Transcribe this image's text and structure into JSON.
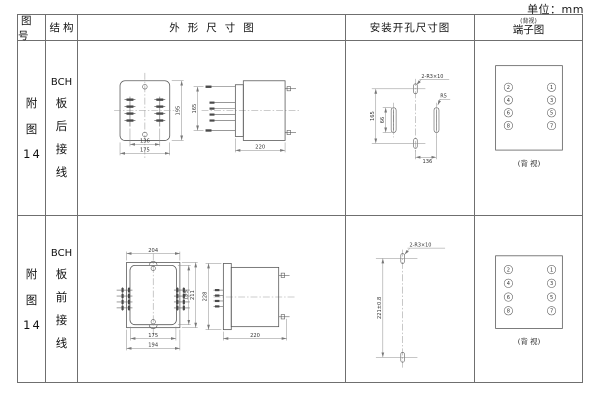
{
  "unit_label": "单位：mm",
  "header": {
    "figure": "图号",
    "structure": "结构",
    "outline": "外形尺寸图",
    "mounting": "安装开孔尺寸图",
    "terminal": "端子图",
    "terminal_note": "(背视)"
  },
  "rows": [
    {
      "figure_lines": [
        "附",
        "图",
        "14"
      ],
      "structure_lines": [
        "BCH",
        "板",
        "后",
        "接",
        "线"
      ],
      "outline": {
        "width_inner": "136",
        "width_outer": "175",
        "height": "195",
        "side_height": "165",
        "depth": "220"
      },
      "mounting": {
        "holes_label": "2-R3×10",
        "radius_label": "R5",
        "height": "165",
        "slot": "66",
        "width": "136"
      },
      "terminal": {
        "left": [
          "2",
          "4",
          "6",
          "8"
        ],
        "right": [
          "1",
          "3",
          "5",
          "7"
        ],
        "caption": "(背 视)"
      }
    },
    {
      "figure_lines": [
        "附",
        "图",
        "14"
      ],
      "structure_lines": [
        "BCH",
        "板",
        "前",
        "接",
        "线"
      ],
      "outline": {
        "width_top": "204",
        "width_inner": "175",
        "width_outer": "194",
        "height_inner": "195",
        "height_outer": "211",
        "side_height": "228",
        "depth": "220"
      },
      "mounting": {
        "holes_label": "2-R3×10",
        "vertical": "221±0.8"
      },
      "terminal": {
        "left": [
          "2",
          "4",
          "6",
          "8"
        ],
        "right": [
          "1",
          "3",
          "5",
          "7"
        ],
        "caption": "(背 视)"
      }
    }
  ]
}
